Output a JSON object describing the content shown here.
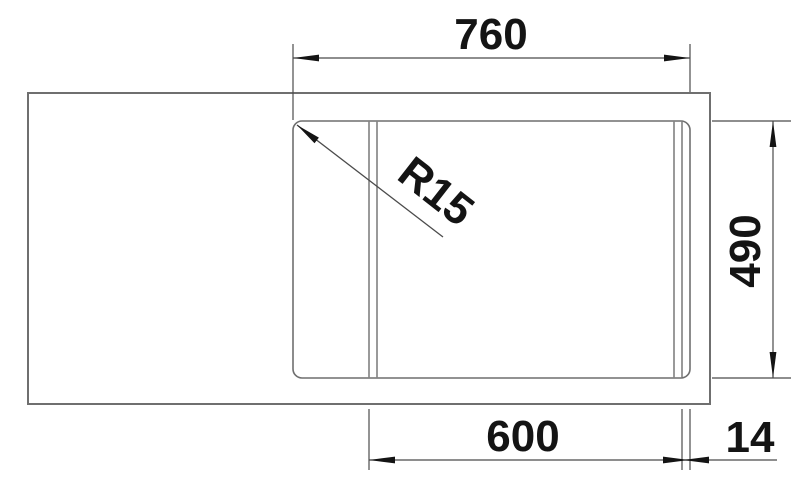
{
  "drawing": {
    "labels": {
      "top_width": "760",
      "right_height": "490",
      "bottom_bowl_width": "600",
      "bottom_rim_offset": "14",
      "corner_radius": "R15"
    },
    "colors": {
      "background": "#ffffff",
      "outline": "#6f6f6f",
      "dimension": "#4b4b4b",
      "text": "#141414"
    }
  }
}
